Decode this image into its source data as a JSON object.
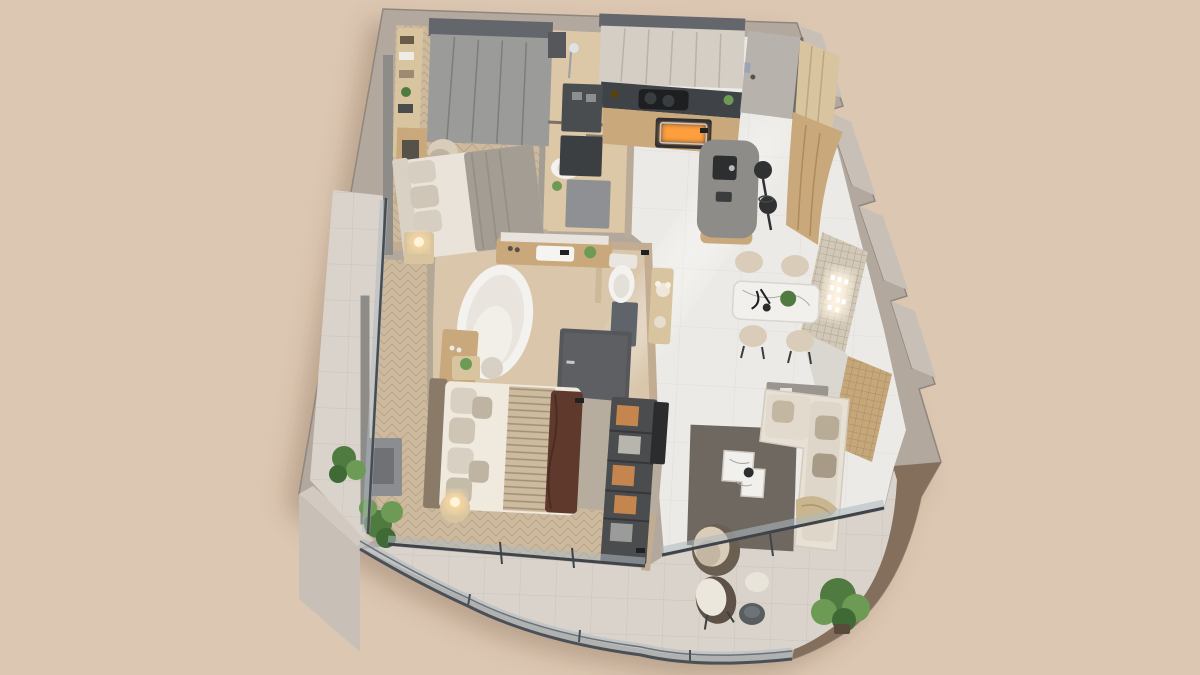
{
  "scene": {
    "type": "3d-isometric-floor-plan-render",
    "view": "axonometric top-down cutaway of a one-to-two bedroom apartment",
    "visible_text": "none",
    "lighting": "warm interior render with glowing lamps, oven light and illuminated wall art"
  },
  "palette": {
    "background": "#dcc7b2",
    "wall_top": "#b2a89e",
    "wall_light": "#c8c0b7",
    "wall_inner": "#c4ae94",
    "wall_gray": "#9d968e",
    "panel_gray": "#8e8c88",
    "parapet_top": "#9d8974",
    "parapet_side": "#75614f",
    "wood_floor": "#cdb99d",
    "wood_floor_light": "#dcc7a6",
    "bath_floor": "#d9c6ab",
    "marble_floor": "#eceae6",
    "balcony_floor": "#d9d3cb",
    "rug_living": "#6f6861",
    "rug_bedroom": "#b6ad9f",
    "sofa": "#e7e1d5",
    "bed_linen": "#efe9de",
    "blanket_gray": "#a49d93",
    "throw_brown": "#5e392c",
    "runner_stripe": "#cdbb9f",
    "wood_cabinet": "#c9a87b",
    "wood_light": "#d8c49e",
    "counter_dark": "#3f4347",
    "island_top": "#8d8c89",
    "wardrobe_gray": "#9b9b99",
    "wardrobe_top": "#63676b",
    "door_gray": "#b7b2ac",
    "stool_black": "#2f3133",
    "tub_white": "#f4f2ee",
    "plant_green": "#4f7b41",
    "plant_green_light": "#6d9a55",
    "glass": "#a9b8c0",
    "frame_dark": "#4a5056",
    "glow": "#ffdda6",
    "oven_glow": "#ff9e3d",
    "art_glow": "#fdf3e0",
    "lattice": "#d2c8b8",
    "lattice_wood": "#c6a77a",
    "marble_table": "#f2f0ec",
    "chair_beige": "#d9cdb9",
    "orange_box": "#c5854e",
    "dark_cabinet": "#55575a"
  },
  "rooms": [
    {
      "id": "second-bedroom",
      "name": "Second Bedroom",
      "floor": "herringbone wood",
      "furniture": [
        "gray wardrobe",
        "open shelving with books and plants",
        "wall desk",
        "desk chair",
        "double bed with gray bedding",
        "nightstand",
        "glowing table lamp",
        "upholstered wall panel"
      ]
    },
    {
      "id": "shower-bathroom",
      "name": "Shower Bathroom",
      "floor": "light wood tile",
      "furniture": [
        "walk-in shower",
        "towel rail partition",
        "washbasin",
        "storage cabinet"
      ]
    },
    {
      "id": "kitchen",
      "name": "Kitchen",
      "floor": "marble tile",
      "furniture": [
        "upper cabinets",
        "dark stone counter",
        "cooktop with pots",
        "built-in oven with warm light",
        "coffee station",
        "tall appliance column",
        "curved island with sink",
        "two black bar stools"
      ]
    },
    {
      "id": "entrance",
      "name": "Entrance Hall",
      "floor": "marble tile",
      "furniture": [
        "entry door",
        "tall hall cabinet",
        "curved wood feature wall"
      ]
    },
    {
      "id": "dining-area",
      "name": "Dining Area",
      "floor": "marble tile",
      "furniture": [
        "marble dining table",
        "four beige chairs",
        "black candelabra centerpiece",
        "table plant",
        "illuminated wall art on lattice panel",
        "slatted wood feature panel",
        "console with flower vase"
      ]
    },
    {
      "id": "master-bathroom",
      "name": "Master Bathroom",
      "floor": "beige stone tile",
      "furniture": [
        "freestanding oval bathtub",
        "double vanity with mirror shelf",
        "toilet in WC niche",
        "dark wardrobe cabinet",
        "dresser with bottles",
        "round stool"
      ]
    },
    {
      "id": "master-bedroom",
      "name": "Master Bedroom",
      "floor": "herringbone wood",
      "furniture": [
        "king bed with white linen",
        "dark brown throw",
        "striped runner",
        "pillow stack",
        "area rug",
        "round nightstand with glowing lamp",
        "small plant table",
        "dark TV console",
        "floor plant",
        "display niche with orange boxes",
        "accent armchair"
      ]
    },
    {
      "id": "living-room",
      "name": "Living Room",
      "floor": "marble tile",
      "furniture": [
        "L-shaped beige sofa",
        "throw blanket",
        "two-tier marble coffee table",
        "dark area rug",
        "sideboard with decor",
        "wall TV panel",
        "swivel armchair",
        "round side table"
      ]
    },
    {
      "id": "balcony",
      "name": "Wraparound Balcony",
      "floor": "light stone tile",
      "furniture": [
        "curved glass railing",
        "lounge chair",
        "round outdoor table",
        "large monstera plant",
        "sliding glass walls"
      ]
    },
    {
      "id": "side-balcony",
      "name": "Side Balcony Strip",
      "floor": "light stone tile",
      "furniture": [
        "glass sliding doors",
        "potted monstera plant"
      ]
    }
  ]
}
